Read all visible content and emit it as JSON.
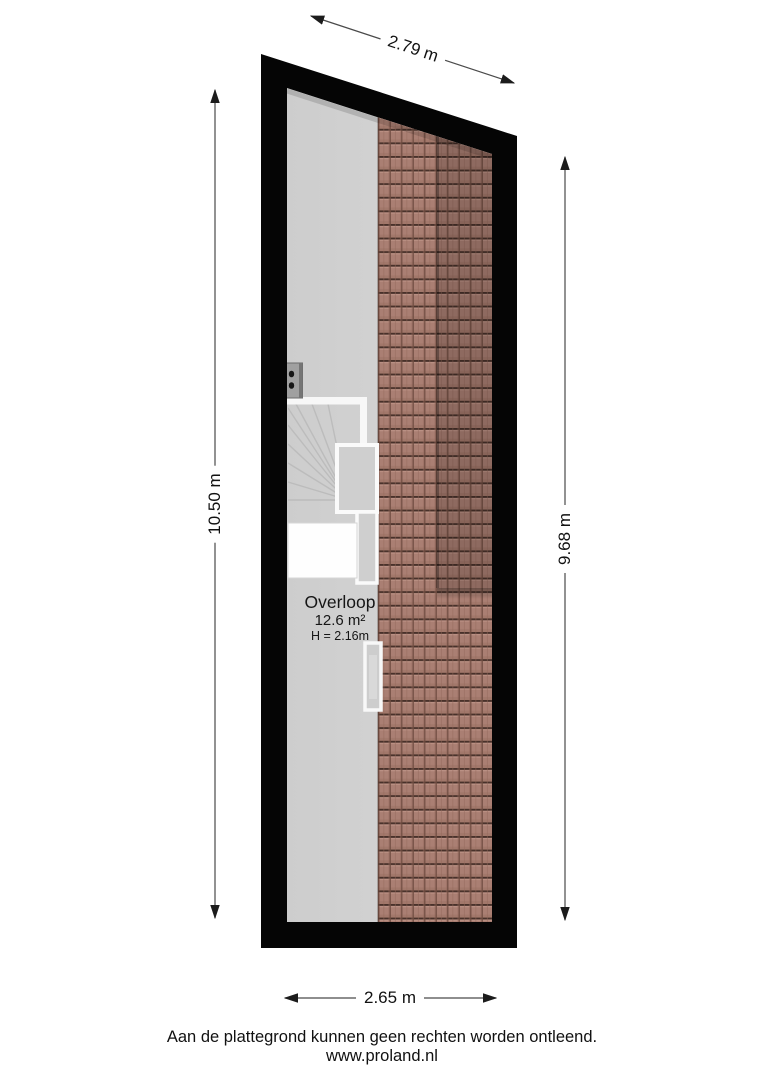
{
  "floorplan": {
    "room": {
      "name": "Overloop",
      "area": "12.6 m²",
      "ceiling_height": "H = 2.16m"
    },
    "dimensions": {
      "top": "2.79 m",
      "left": "10.50 m",
      "right": "9.68 m",
      "bottom": "2.65 m"
    },
    "footer": {
      "disclaimer": "Aan de plattegrond kunnen geen rechten worden ontleend.",
      "website": "www.proland.nl"
    },
    "colors": {
      "wall": "#050505",
      "floor": "#d3d3d3",
      "tile_base": "#aa7f73",
      "tile_line": "#3a2720",
      "dimension_line": "#222222"
    }
  }
}
